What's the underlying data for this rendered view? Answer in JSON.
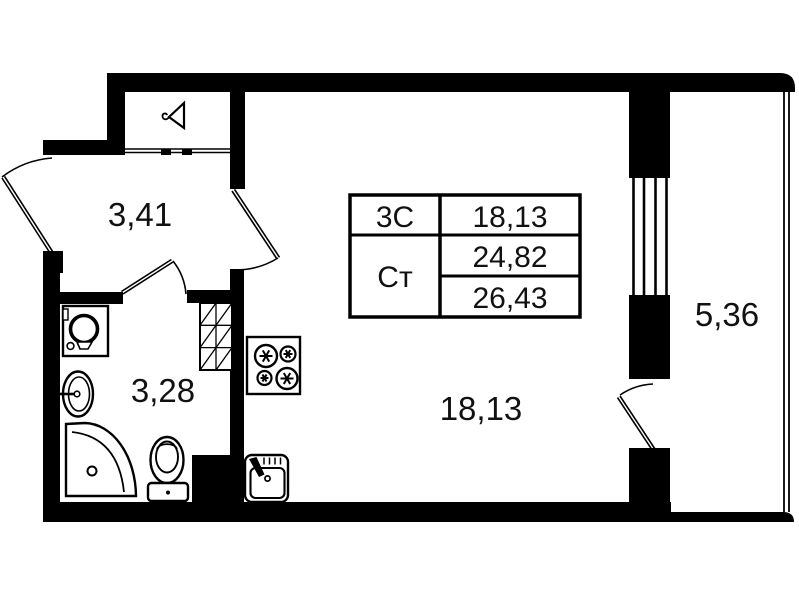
{
  "plan_title": "Studio apartment floor plan",
  "rooms": {
    "hallway": {
      "name": "hallway",
      "area": "3,41"
    },
    "bathroom": {
      "name": "bathroom",
      "area": "3,28"
    },
    "living": {
      "name": "living-room",
      "area": "18,13"
    },
    "balcony": {
      "name": "balcony",
      "area": "5,36"
    }
  },
  "info_table": {
    "row1_label": "3С",
    "row1_value": "18,13",
    "row2_label": "Ст",
    "row2_value1": "24,82",
    "row2_value2": "26,43"
  },
  "icons": {
    "wardrobe": "hanger-icon",
    "bathroom_fixtures": [
      "washing-machine-icon",
      "washbasin-icon",
      "shower-tray-icon",
      "toilet-icon"
    ],
    "kitchen_fixtures": [
      "stove-icon",
      "kitchen-sink-icon"
    ],
    "shaft": "ventilation-shaft-hatch"
  },
  "colors": {
    "wall": "#000000",
    "background": "#ffffff",
    "text": "#111111"
  }
}
